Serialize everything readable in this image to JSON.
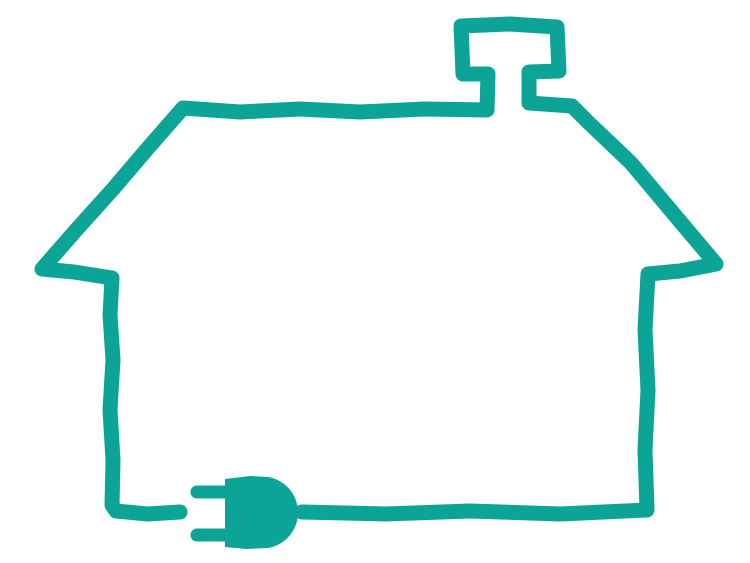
{
  "page": {
    "background_color": "#ffffff"
  },
  "illustration": {
    "name": "house-outline-with-power-plug",
    "line_color": "#0ca496",
    "plug_color": "#0ca496"
  }
}
